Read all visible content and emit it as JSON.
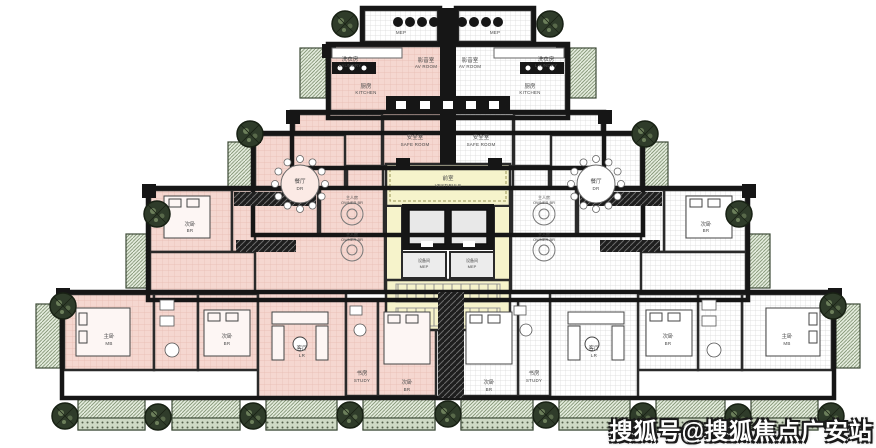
{
  "watermark": "搜狐号@搜狐焦点广安站",
  "colors": {
    "unit_highlight_pink": "#f5d7d0",
    "neutral_unit_white": "#ffffff",
    "core_yellow": "#f6f3cb",
    "terrace_green": "#e3ebdc",
    "tree_green": "#2f3c2a",
    "wall_black": "#161616"
  },
  "labels": {
    "mep_en": "MEP",
    "mep_zh": "设备间",
    "kitchen_zh": "厨房",
    "kitchen_en": "KITCHEN",
    "laundry_zh": "洗衣房",
    "laundry_en": "LAUNDRY",
    "av_zh": "影音室",
    "av_en": "AV ROOM",
    "safe_zh": "安全室",
    "safe_en": "SAFE ROOM",
    "vestibule_zh": "前室",
    "vestibule_en": "VESTIBULE",
    "owner_zh": "主人房",
    "owner_en": "OWNER BR",
    "dining_zh": "餐厅",
    "dining_en": "DR",
    "living_zh": "客厅",
    "living_en": "LR",
    "study_zh": "书房",
    "study_en": "STUDY",
    "master_zh": "主卧",
    "master_en": "MB",
    "bedroom_zh": "次卧",
    "bedroom_en": "BR"
  }
}
